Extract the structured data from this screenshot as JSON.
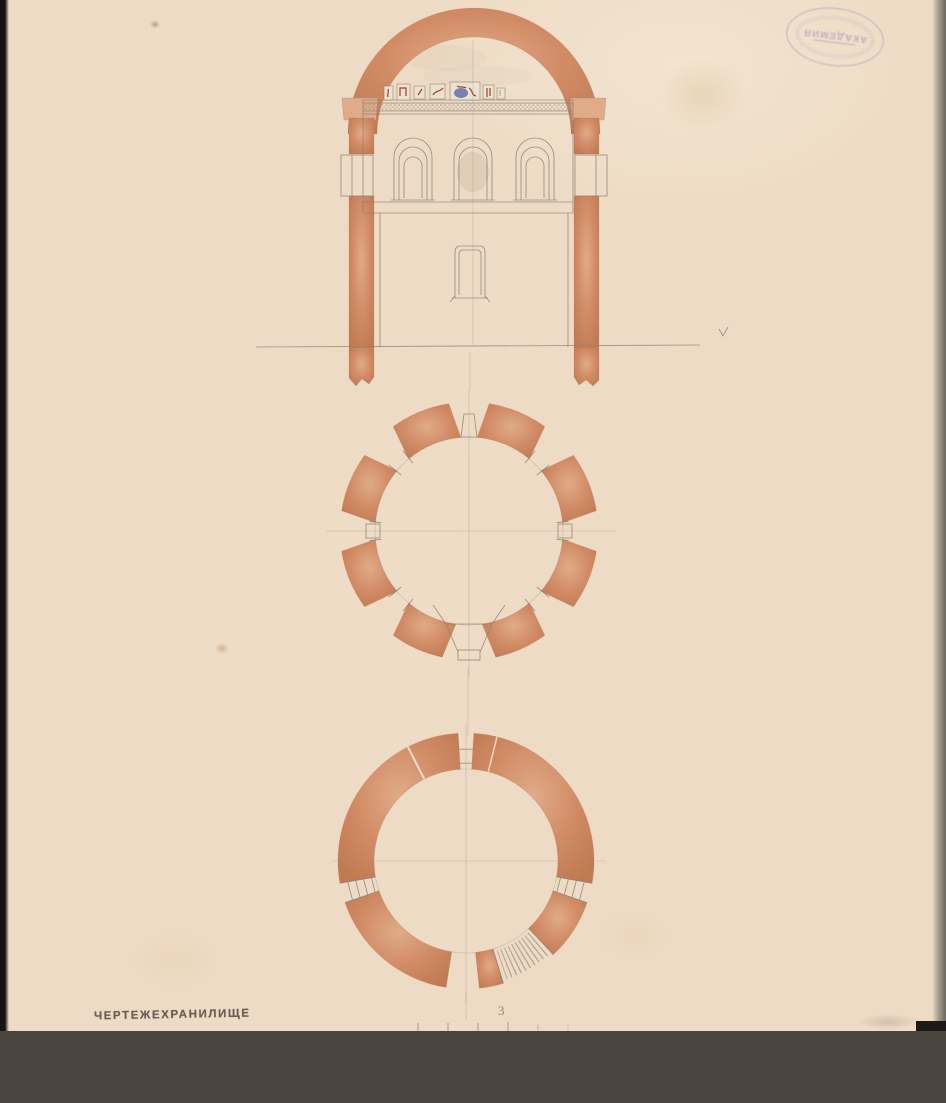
{
  "stamps": {
    "academy_oval": {
      "center_text": "АКАДЕМИЯ"
    },
    "repository": {
      "text": "ЧЕРТЕЖЕХРАНИЛИЩЕ"
    }
  },
  "scale_bar": {
    "label": "3",
    "tick_count": 6
  },
  "colors": {
    "paper": "#eedbc5",
    "terracotta": "#d08a64",
    "terracotta_light": "#e0ab88",
    "terracotta_dark": "#c07a52",
    "pencil": "#8b8274",
    "ink_stamp_purple": "#8f86b8",
    "stamp_gray": "#4a443d",
    "band_dark": "#4a453f",
    "edge_black": "#15120f",
    "fragment_red": "#a93a33",
    "fragment_blue": "#5568a8",
    "scale_number": "#936b50"
  }
}
